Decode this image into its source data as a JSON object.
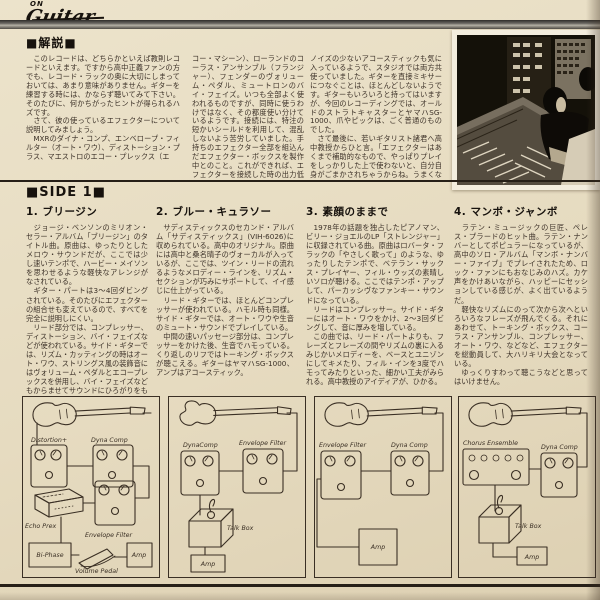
{
  "colors": {
    "paper": "#e7ddc4",
    "ink": "#3c3128",
    "bar": "#6f6c66",
    "rule": "#261f17"
  },
  "logo": {
    "on": "ON",
    "guitar": "Guitar"
  },
  "section_header": "■解説■",
  "intro": {
    "columns": [
      "　このレコードは、どちらかといえば教則レコードといえます。ですから高中正義ファンの方でも、レコード・ラックの奥に大切にしまっておいては、あまり意味がありません。ギターを練習する時には、かならず聴いてみて下さい。そのたびに、何かちがったヒントが得られるハズです。\n　さて、彼の使っているエフェクターについて説明してみましょう。\n　MXRのダイナ・コンプ、エンベロープ・フィルター（オート・ワウ）、ディストーション・プラス、マエストロのエコー・プレックス（エ",
      "コー・マシーン）、ローランドのコーラス・アンサンブル（フランジャー）、フェンダーのヴォリューム・ペダル、ミュートロンのバイ・フェイズ。いつも全部よく使われるものですが、同時に使うわけではなく、その都度使い分けているようです。接続には、特注の短かいシールドを利用して、混乱しないよう苦労していました。手持ちのエフェクター全部を組込んだエフェクター・ボックスを製作中とのこと。これができれば、エフェクターを接続した時の出力低下も防げるそうです。\n　使用アンプは、ブギーとアコースティック。たいていは、ブギーの方を使うそうですが、",
      "ノイズの少ないアコースティックも気に入っているようで、スタジオでは両方共使っていました。ギターを直接ミキサーにつなぐことは、ほとんどしないようです。ギターもいろいろと持ってはいますが、今回のレコーディングでは、オールドのストラトキャスターとヤマハSG-1000、爪やピックは、ごく普通のものでした。\n　さて最後に、若いギタリスト諸君へ高中教授からひと言。「エフェクターはあくまで補助的なもので、やっぱりプレイをしっかりした上で使わないと、自分自身がごまかされちゃうからね。うまくなったような気がするだけじゃ、何の役にもたたないから──」。"
    ]
  },
  "side1": {
    "header": "■SIDE 1■",
    "tracks": [
      {
        "title": "1. ブリージン",
        "body": "　ジョージ・ベンソンのミリオン・セラー・アルバム「ブリージン」のタイトル曲。原曲は、ゆったりとしたメロウ・サウンドだが、ここでは少し速いテンポで、ハービー・メイソンを思わせるような軽快なアレンジがなされている。\n　ギター・パートは3〜4回ダビングされている。そのたびにエフェクターの組合せも変えているので、すべてを完全に説明しにくい。\n　リード部分では、コンプレッサー、ディストーション、バイ・フェイズなどが使われている。サイド・ギターでは、リズム・カッティングの時はオート・ワウ、ストリングス風の装飾音にはヴォリューム・ペダルとエコープレックスを併用し、バイ・フェイズなどもからませてサウンドにひろがりをもたせている。"
      },
      {
        "title": "2. ブルー・キュラソー",
        "body": "　サディスティックスのセカンド・アルバム「サディスティックス」(VIH-6026)に収められている。高中のオリジナル。原曲には高中と桑名晴子のヴォーカルが入っているが、ここでは、ツイン・リードの流れるようなメロディー・ラインを、リズム・セクションが巧みにサポートして、イイ感じに仕上がっている。\n　リード・ギターでは、ほとんどコンプレッサーが使われている。ハモル時も同様。サイド・ギターでは、オート・ワウや生音のミュート・サウンドでプレイしている。\n　中間の速いパッセージ部分は、コンプレッサーをかけた後、生音でハモっている。くり返しのリフではトーキング・ボックスが聴こえる。ギターはヤマハSG-1000、アンプはアコースティック。"
      },
      {
        "title": "3. 素顔のままで",
        "body": "　1978年の話題を独占したピアノマン、ビリー・ジョエルのLP「ストレンジャー」に収録されている曲。原曲はロバータ・フラックの「やさしく歌って」のような、ゆったりしたテンポで、ベテラン・サックス・プレイヤー、フィル・ウッズの素晴しいソロが聴ける。ここではテンポ・アップして、パーカッシヴなファンキー・サウンドになっている。\n　リードはコンプレッサー。サイド・ギターにはオート・ワウをかけ、2〜3回ダビングして、音に厚みを増している。\n　この曲では、リード・パートよりも、フレーズとフレーズの間やリズムの裏に入るみじかいメロディーを、ベースとユニゾンにしてキメたり、フィル・インを3度でハモってみたりといった、細かい工夫がみられる。高中教授のアイディアが、ひかる。"
      },
      {
        "title": "4. マンボ・ジャンボ",
        "body": "　ラテン・ミュージックの巨匠、ペレス・プラードのヒット曲。ラテン・ナンバーとしてポピュラーになっているが、高中のソロ・アルバム「マンボ・ナンバー・ファイブ」でプレイされたため、ロック・ファンにもおなじみのハズ。カケ声をかけあいながら、ハッピーにセッションしている感じが、よく出ているようだ。\n　軽快なリズムにのって次から次へといろいろなフレーズが飛んでくる。それにあわせて、トーキング・ボックス、コーラス・アンサンブル、コンプレッサー、オート・ワウ、などなど、エフェクターを総動員して、大ハリキリ大会となっている。\n　ゆっくりすわって聴こうなどと思ってはいけません。"
      }
    ]
  },
  "diagrams": [
    {
      "labels": [
        "Distortion+",
        "Dyna Comp",
        "Echo Prex",
        "Envelope Filter",
        "Bi-Phase",
        "Volume Pedal",
        "Amp"
      ]
    },
    {
      "labels": [
        "DynaComp",
        "Envelope Filter",
        "Talk Box",
        "Amp"
      ]
    },
    {
      "labels": [
        "Envelope Filter",
        "Dyna Comp",
        "Amp"
      ]
    },
    {
      "labels": [
        "Chorus Ensemble",
        "Dyna Comp",
        "Talk Box",
        "Amp"
      ]
    }
  ]
}
